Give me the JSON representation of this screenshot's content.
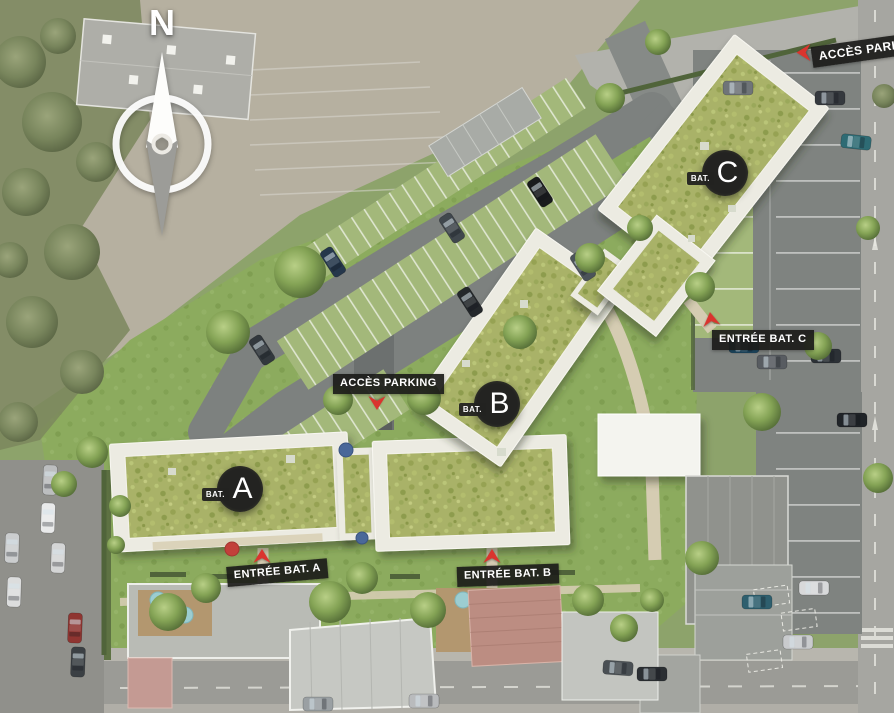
{
  "compass": {
    "label": "N"
  },
  "access_labels": {
    "top": "ACCÈS PARKING",
    "center": "ACCÈS PARKING"
  },
  "entrance_labels": {
    "a": "ENTRÉE BAT. A",
    "b": "ENTRÉE BAT. B",
    "c": "ENTRÉE BAT. C"
  },
  "buildings": [
    {
      "id": "A",
      "badge_prefix": "BAT.",
      "badge_letter": "A"
    },
    {
      "id": "B",
      "badge_prefix": "BAT.",
      "badge_letter": "B"
    },
    {
      "id": "C",
      "badge_prefix": "BAT.",
      "badge_letter": "C"
    }
  ],
  "icons": {
    "compass": "compass-rose-icon",
    "direction_arrows": "red-chevron-arrow-icon"
  },
  "colors": {
    "arrow_red": "#da342e",
    "label_bg": "#1c1c1a",
    "label_text": "#ffffff",
    "badge_bg": "#232321",
    "roof_vegetation": "#a9b267",
    "grass": "#8cab5e",
    "asphalt": "#7d817f"
  }
}
